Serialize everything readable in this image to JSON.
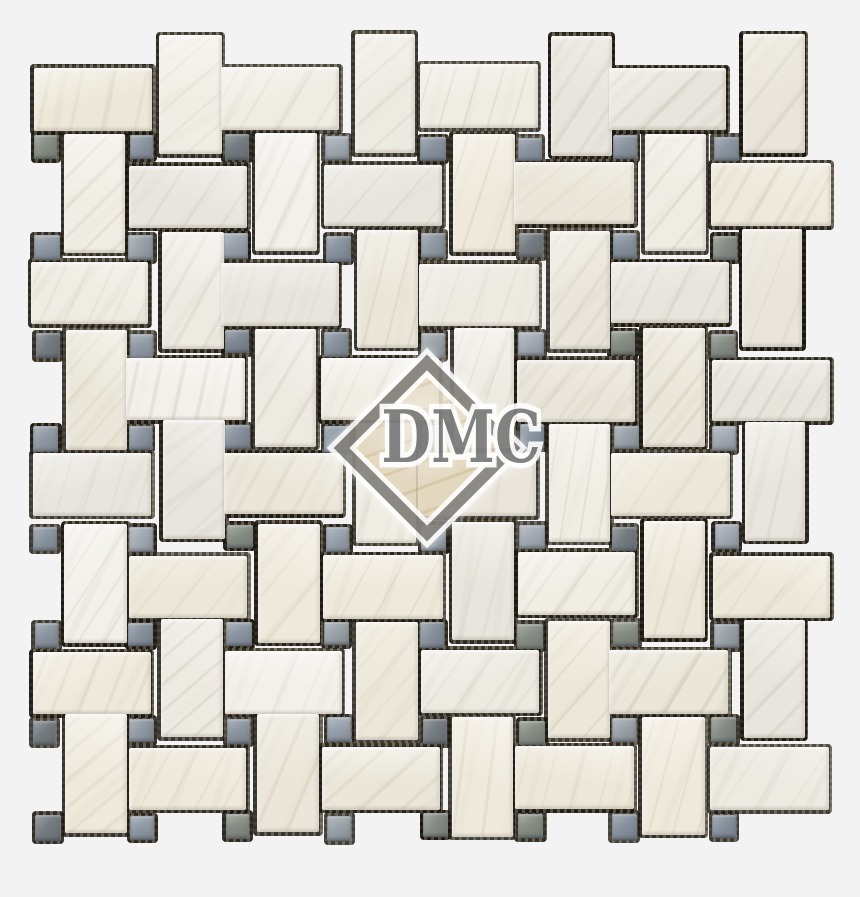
{
  "page": {
    "background_color": "#f3f3f3",
    "width": 860,
    "height": 897
  },
  "watermark": {
    "text": "DMC",
    "text_color": "#707070",
    "outline_color": "#ffffff",
    "diamond_border_color": "#6e6e6e",
    "diamond_fill_color": "#e1d5ba",
    "center_x": 416,
    "center_y": 437,
    "diamond_size": 110
  },
  "mosaic": {
    "pattern": "basketweave-with-dots",
    "origin_x": 33,
    "origin_y": 39,
    "pitch": 97,
    "cols": 8,
    "rows": 8,
    "dot_size": 25,
    "tile_long": 119,
    "tile_short": 62,
    "joint_halo": 3.5,
    "seed": 20240613,
    "grout_color": "#46402f",
    "grout_dark": "#241f18",
    "tile_palette": [
      "#f2f0ea",
      "#edeae2",
      "#efece3",
      "#e9e5da",
      "#eee9db",
      "#e7e5dd",
      "#f0ede4",
      "#eae6d9",
      "#ece7d8"
    ],
    "dot_palette": [
      "#98a1ac",
      "#8b95a1",
      "#a2aab3",
      "#7f8995",
      "#909aa4",
      "#87929e",
      "#9aa3a9",
      "#747c81",
      "#868d84"
    ],
    "vein_color_rgb": "158,146,120",
    "vein_color2_rgb": "194,184,160"
  }
}
